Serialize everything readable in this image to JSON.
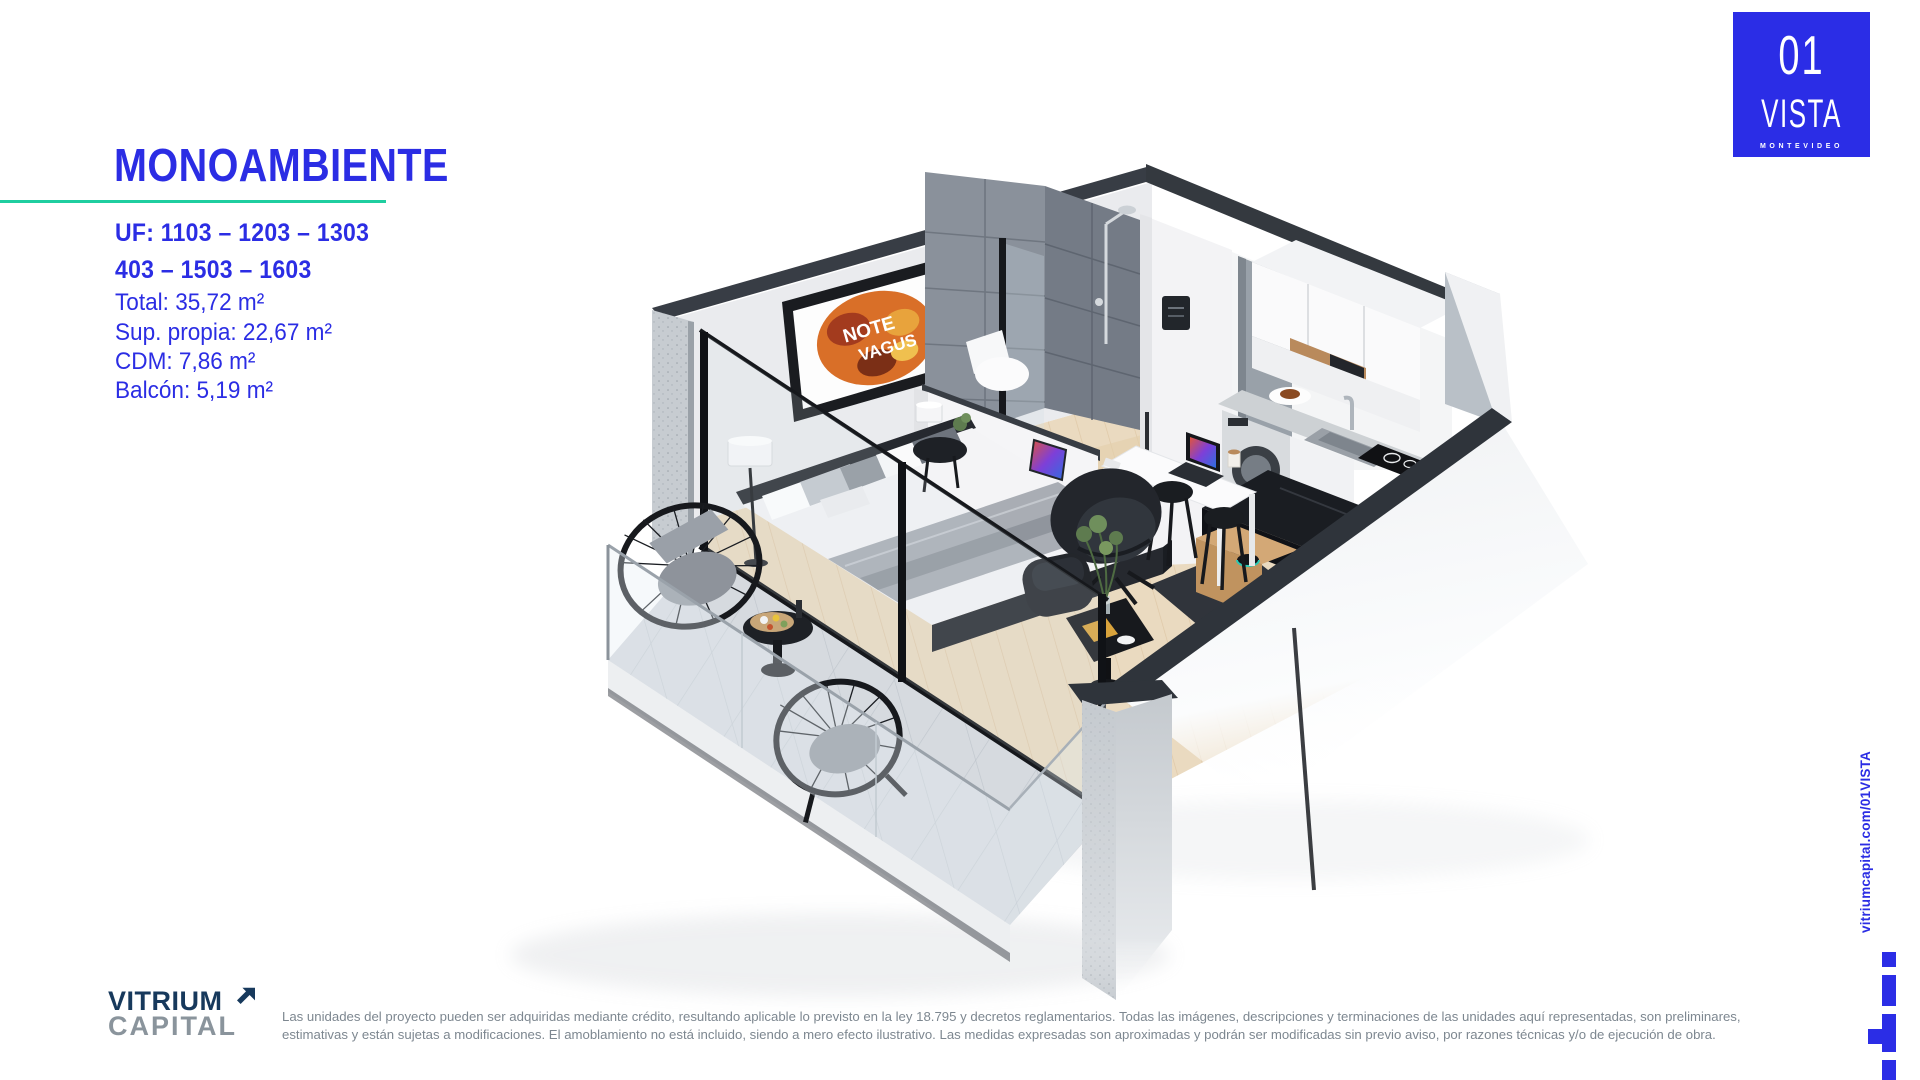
{
  "colors": {
    "brand_blue": "#2B2DE4",
    "teal": "#1FCEA0",
    "navy": "#17395C",
    "gray": "#8A949C",
    "disclaimer_gray": "#7D8790"
  },
  "panel": {
    "title": "MONOAMBIENTE",
    "uf_line1": "UF: 1103 – 1203 – 1303",
    "uf_line2": "403 – 1503 – 1603",
    "specs": [
      "Total: 35,72 m²",
      "Sup. propia: 22,67 m²",
      "CDM: 7,86 m²",
      "Balcón: 5,19 m²"
    ]
  },
  "project_logo": {
    "number": "01",
    "name": "VISTA",
    "city": "MONTEVIDEO"
  },
  "footer": {
    "brand_line1": "VITRIUM",
    "brand_line2": "CAPITAL",
    "disclaimer_line1": "Las unidades del proyecto pueden ser adquiridas mediante crédito, resultando aplicable lo previsto en la ley 18.795 y decretos reglamentarios. Todas las imágenes, descripciones y terminaciones de las unidades aquí representadas, son preliminares,",
    "disclaimer_line2": "estimativas y están sujetas a modificaciones. El amoblamiento no está incluido, siendo a mero efecto ilustrativo. Las medidas expresadas son aproximadas y podrán ser modificadas sin previo aviso, por razones técnicas y/o de ejecución de obra."
  },
  "sidebar": {
    "url": "vitriumcapital.com/01VISTA"
  },
  "scene": {
    "alt": "3D isometric render of studio apartment with balcony",
    "wall_art_line1": "NOTE",
    "wall_art_line2": "VAGUS"
  }
}
